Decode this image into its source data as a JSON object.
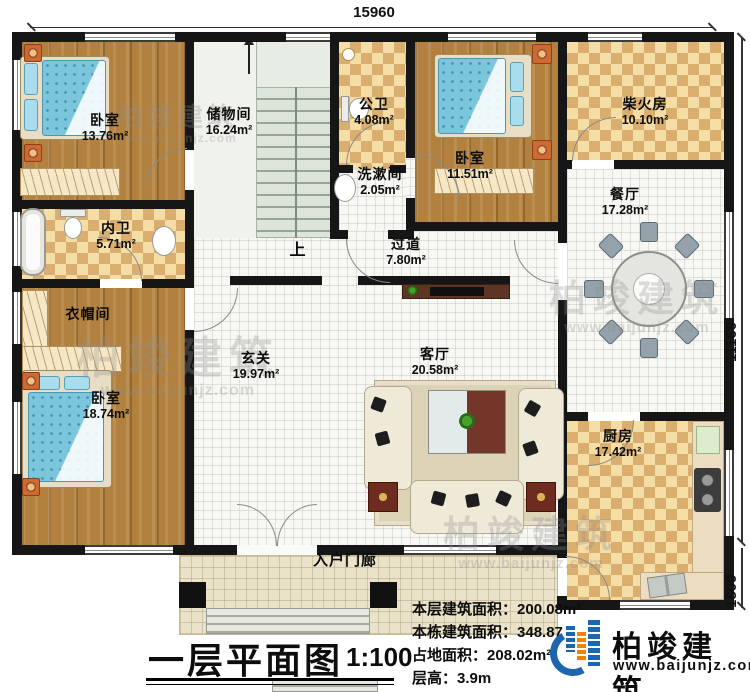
{
  "plan": {
    "title": "一层平面图",
    "scale": "1:100",
    "stair_up_label": "上",
    "dimensions": {
      "top_width": "15960",
      "right_height": "11160",
      "right_porch_depth": "1800"
    }
  },
  "rooms": [
    {
      "name": "卧室",
      "area": "13.76m²"
    },
    {
      "name": "储物间",
      "area": "16.24m²"
    },
    {
      "name": "公卫",
      "area": "4.08m²"
    },
    {
      "name": "洗漱间",
      "area": "2.05m²"
    },
    {
      "name": "卧室",
      "area": "11.51m²"
    },
    {
      "name": "柴火房",
      "area": "10.10m²"
    },
    {
      "name": "餐厅",
      "area": "17.28m²"
    },
    {
      "name": "内卫",
      "area": "5.71m²"
    },
    {
      "name": "衣帽间",
      "area": ""
    },
    {
      "name": "卧室",
      "area": "18.74m²"
    },
    {
      "name": "过道",
      "area": "7.80m²"
    },
    {
      "name": "玄关",
      "area": "19.97m²"
    },
    {
      "name": "客厅",
      "area": "20.58m²"
    },
    {
      "name": "厨房",
      "area": "17.42m²"
    },
    {
      "name": "入户门廊",
      "area": ""
    }
  ],
  "stats": [
    {
      "label": "本层建筑面积：",
      "value": "200.08m²"
    },
    {
      "label": "本栋建筑面积：",
      "value": "348.87"
    },
    {
      "label": "占地面积：",
      "value": "208.02m²"
    },
    {
      "label": "层高：",
      "value": "3.9m"
    }
  ],
  "brand": {
    "name": "柏竣建筑",
    "website": "www.baijunjz.com"
  },
  "watermark": {
    "name": "柏竣建筑",
    "website": "www.baijunjz.com"
  },
  "colors": {
    "wall": "#161616",
    "wood_floor": "#b2813f",
    "tile_light": "#f5dda6",
    "tile_dark": "#d9ae6e",
    "mattress_blue": "#7cc6dd",
    "brand_blue": "#1b66ad",
    "brand_orange": "#ef8200"
  }
}
